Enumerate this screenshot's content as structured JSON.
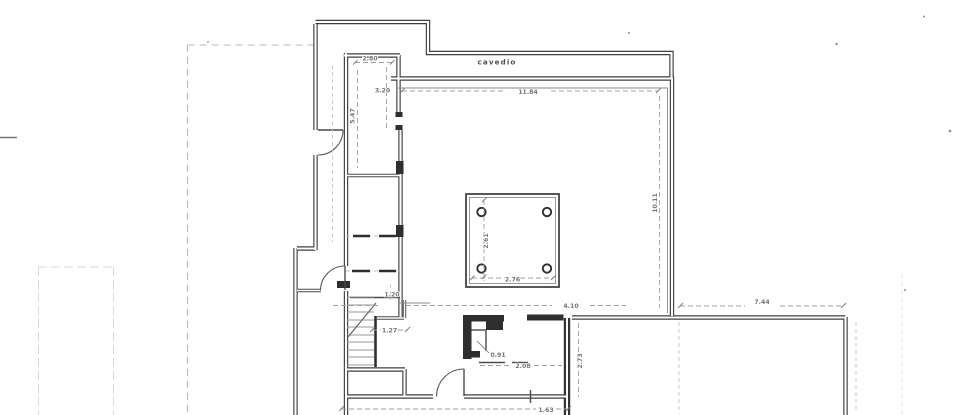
{
  "plan": {
    "area_label": "cavedio",
    "dimension_labels": {
      "top_room_width": "2.80",
      "top_room_height": "3.20",
      "corridor_height": "5.47",
      "main_room_width": "11.84",
      "main_room_height": "10.11",
      "shaft_height": "2.61",
      "shaft_width": "2.76",
      "stair_landing_upper": "1.20",
      "stair_landing_lower": "1.27",
      "bottom_left_span": "4.10",
      "bath_width": "2.08",
      "bath_niche": "0.91",
      "right_room_width": "7.44",
      "bath_right_height": "2.73",
      "bottom_window_span": "1.63"
    },
    "colors": {
      "paper": "#ffffff",
      "ink": "#3f3f3f",
      "ink_dark_fill": "#2e2e2e",
      "dimension_line": "#9f9f9f",
      "faint_scan_line": "#d8d8d8",
      "label_text": "#757575"
    }
  }
}
